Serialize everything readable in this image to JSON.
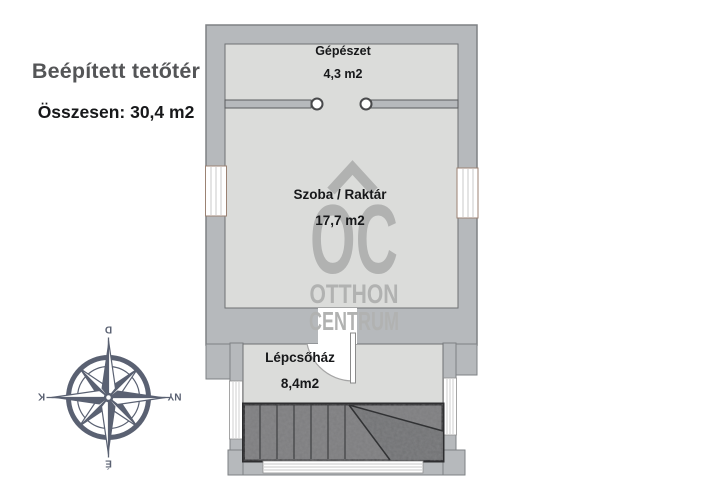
{
  "summary": {
    "title": "Beépített tetőtér",
    "total": "Összesen: 30,4 m2"
  },
  "rooms": [
    {
      "name": "Gépészet",
      "area": "4,3 m2"
    },
    {
      "name": "Szoba / Raktár",
      "area": "17,7 m2"
    },
    {
      "name": "Lépcsőház",
      "area": "8,4m2"
    }
  ],
  "watermark": {
    "monogram": "OC",
    "word1": "OTTHON",
    "word2": "CENTRUM"
  },
  "compass": {
    "top": "D",
    "right": "NY",
    "bottom": "É",
    "left": "K"
  },
  "colors": {
    "wall": "#b6b9bc",
    "wall_outline": "#7e8184",
    "room_fill": "#dbdcda",
    "stair_fill": "#7d7d7f",
    "stair_line": "#37383a",
    "watermark_gray": "#b1b2b1",
    "compass_slate": "#5a6172",
    "title_gray": "#545557",
    "text_black": "#17181a",
    "window_frame": "#9b8273"
  }
}
